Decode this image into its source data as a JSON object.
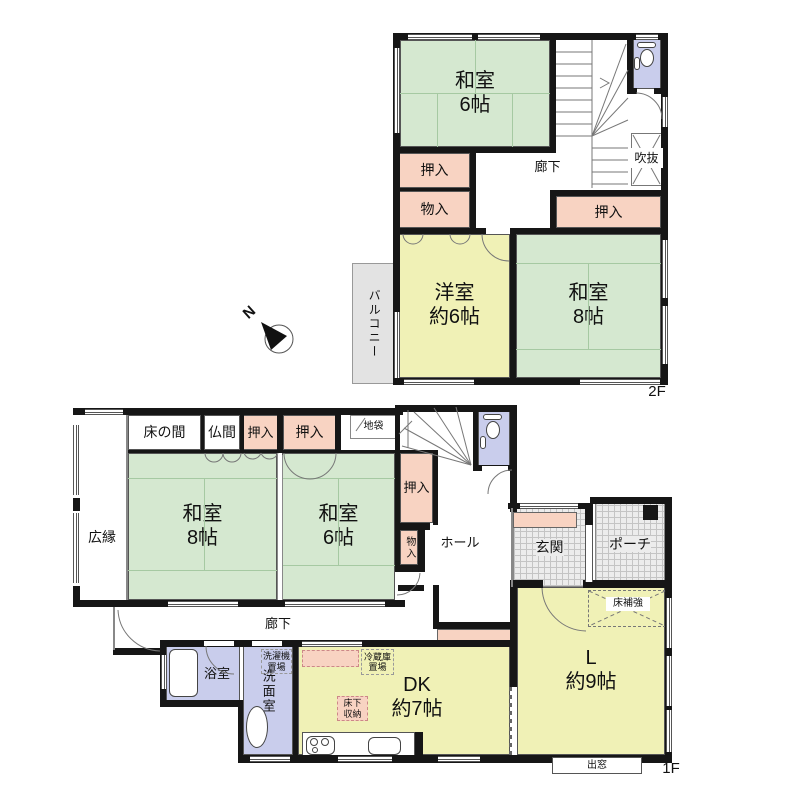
{
  "f2": {
    "floor_label": "2F",
    "washitsu6": "和室\n6帖",
    "oshiire_left": "押入",
    "monoire": "物入",
    "rouka": "廊下",
    "fukinuke": "吹抜",
    "oshiire_right": "押入",
    "youshitsu": "洋室\n約6帖",
    "washitsu8": "和室\n8帖",
    "balcony": "バルコニー"
  },
  "f1": {
    "floor_label": "1F",
    "tokonoma": "床の間",
    "butsuma": "仏間",
    "oshiire_a": "押入",
    "oshiire_b": "押入",
    "jibukuro": "地袋",
    "hiroen": "広縁",
    "washitsu8": "和室\n8帖",
    "washitsu6": "和室\n6帖",
    "oshiire_c": "押入",
    "monoire": "物入",
    "hall": "ホール",
    "genkan": "玄関",
    "porch": "ポーチ",
    "rouka": "廊下",
    "bath": "浴室",
    "senmen": "洗面室",
    "sentakuki": "洗濯機\n置場",
    "reizouko": "冷蔵庫\n置場",
    "yukashita": "床下\n収納",
    "dk": "DK\n約7帖",
    "living": "L\n約9帖",
    "yukahokyo": "床補強",
    "demado": "出窓"
  },
  "compass": {
    "north": "N"
  },
  "colors": {
    "tatami": "#d5e8d0",
    "western": "#f0f1b6",
    "closet": "#f8d3c2",
    "wet_area": "#c9cdec",
    "balcony": "#e3e3e3",
    "wall": "#161616"
  }
}
